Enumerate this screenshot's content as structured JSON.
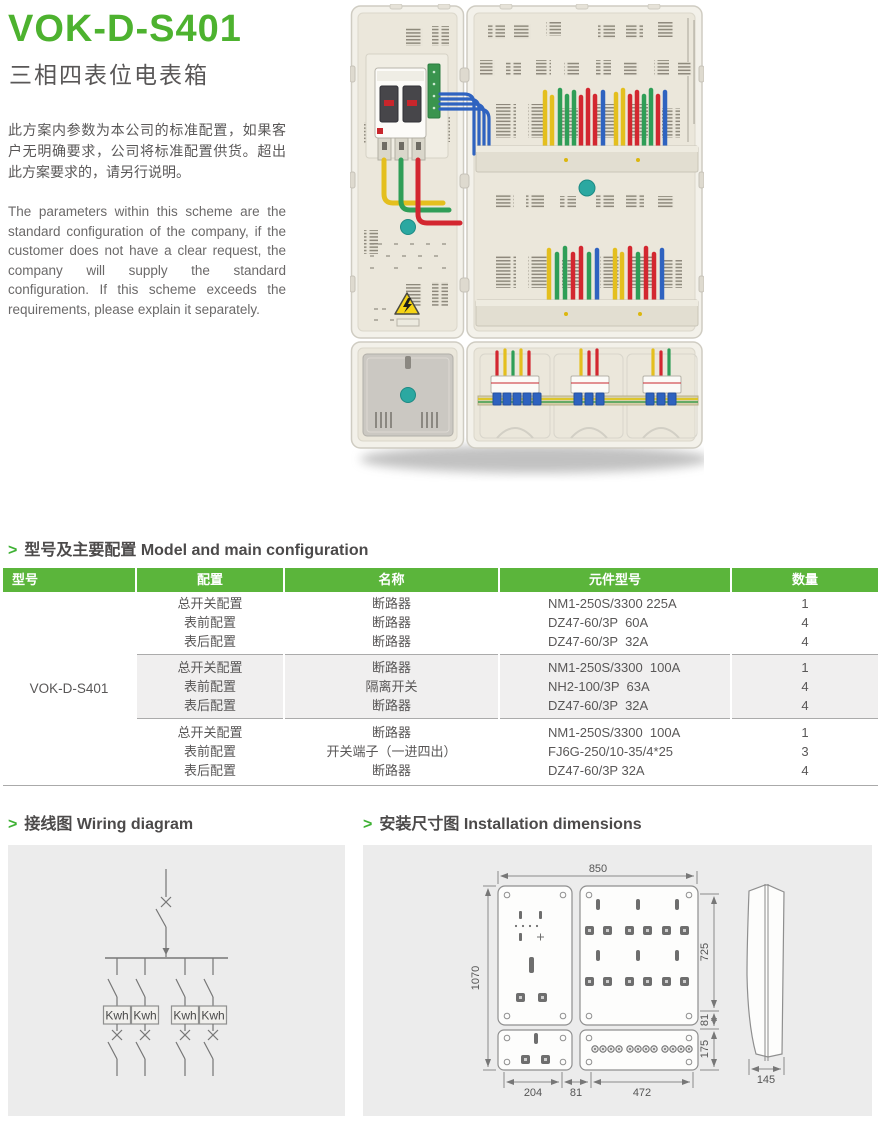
{
  "page": {
    "title": "VOK-D-S401",
    "subtitle": "三相四表位电表箱",
    "intro_zh": "此方案内参数为本公司的标准配置，如果客户无明确要求，公司将标准配置供货。超出此方案要求的，请另行说明。",
    "intro_en": "The parameters within this scheme are the standard configuration of the company, if the customer does not have a clear request, the company will supply the standard configuration. If this scheme exceeds the requirements, please explain it separately."
  },
  "colors": {
    "accent_green": "#4db22f",
    "table_header_green": "#5bb53b",
    "text_dark": "#595757",
    "panel_gray": "#ececec",
    "wire_yellow": "#e4bf1e",
    "wire_green": "#2f9e57",
    "wire_red": "#d32730",
    "wire_blue": "#2f63c0"
  },
  "sections": {
    "config": {
      "marker": ">",
      "title_zh": "型号及主要配置",
      "title_en": "Model and main configuration"
    },
    "wiring": {
      "marker": ">",
      "title_zh": "接线图",
      "title_en": "Wiring diagram"
    },
    "dims": {
      "marker": ">",
      "title_zh": "安装尺寸图",
      "title_en": "Installation dimensions"
    }
  },
  "table": {
    "headers": [
      "型号",
      "配置",
      "名称",
      "元件型号",
      "数量"
    ],
    "model": "VOK-D-S401",
    "groups": [
      {
        "rows": [
          {
            "config": "总开关配置",
            "name": "断路器",
            "part": "NM1-250S/3300 225A",
            "qty": "1"
          },
          {
            "config": "表前配置",
            "name": "断路器",
            "part": "DZ47-60/3P  60A",
            "qty": "4"
          },
          {
            "config": "表后配置",
            "name": "断路器",
            "part": "DZ47-60/3P  32A",
            "qty": "4"
          }
        ]
      },
      {
        "rows": [
          {
            "config": "总开关配置",
            "name": "断路器",
            "part": "NM1-250S/3300  100A",
            "qty": "1"
          },
          {
            "config": "表前配置",
            "name": "隔离开关",
            "part": "NH2-100/3P  63A",
            "qty": "4"
          },
          {
            "config": "表后配置",
            "name": "断路器",
            "part": "DZ47-60/3P  32A",
            "qty": "4"
          }
        ]
      },
      {
        "rows": [
          {
            "config": "总开关配置",
            "name": "断路器",
            "part": "NM1-250S/3300  100A",
            "qty": "1"
          },
          {
            "config": "表前配置",
            "name": "开关端子（一进四出）",
            "part": "FJ6G-250/10-35/4*25",
            "qty": "3"
          },
          {
            "config": "表后配置",
            "name": "断路器",
            "part": "DZ47-60/3P 32A",
            "qty": "4"
          }
        ]
      }
    ]
  },
  "wiring": {
    "meter_label": "Kwh",
    "meter_count": 4
  },
  "dims": {
    "top_width": "850",
    "left_height": "1070",
    "right_height": "725",
    "right_gap": "81",
    "bottom_row_height": "175",
    "bottom_left": "204",
    "bottom_gap": "81",
    "bottom_right": "472",
    "depth": "145"
  }
}
